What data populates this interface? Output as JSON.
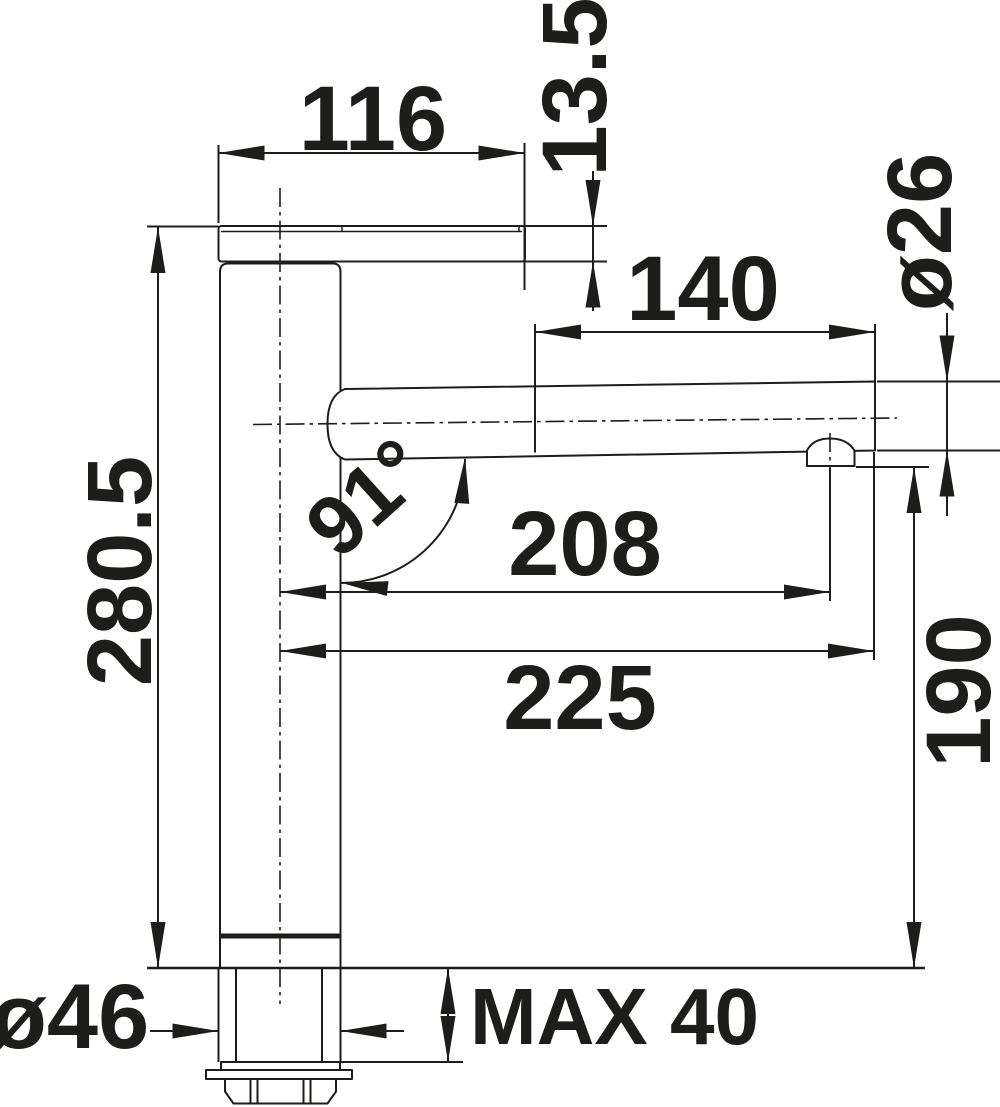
{
  "drawing": {
    "kind": "faucet installation dimension drawing",
    "view": "side elevation",
    "colors": {
      "line": "#1d1d1b",
      "background": "#ffffff"
    },
    "dims": {
      "top_width": "116",
      "lever_thickness": "13.5",
      "spray_head_length": "140",
      "spout_diameter": "ø26",
      "body_height": "280.5",
      "spout_angle": "91°",
      "aerator_projection": "208",
      "spout_projection": "225",
      "underspout_clearance": "190",
      "base_diameter": "ø46",
      "max_deck_thickness": "MAX 40"
    }
  }
}
